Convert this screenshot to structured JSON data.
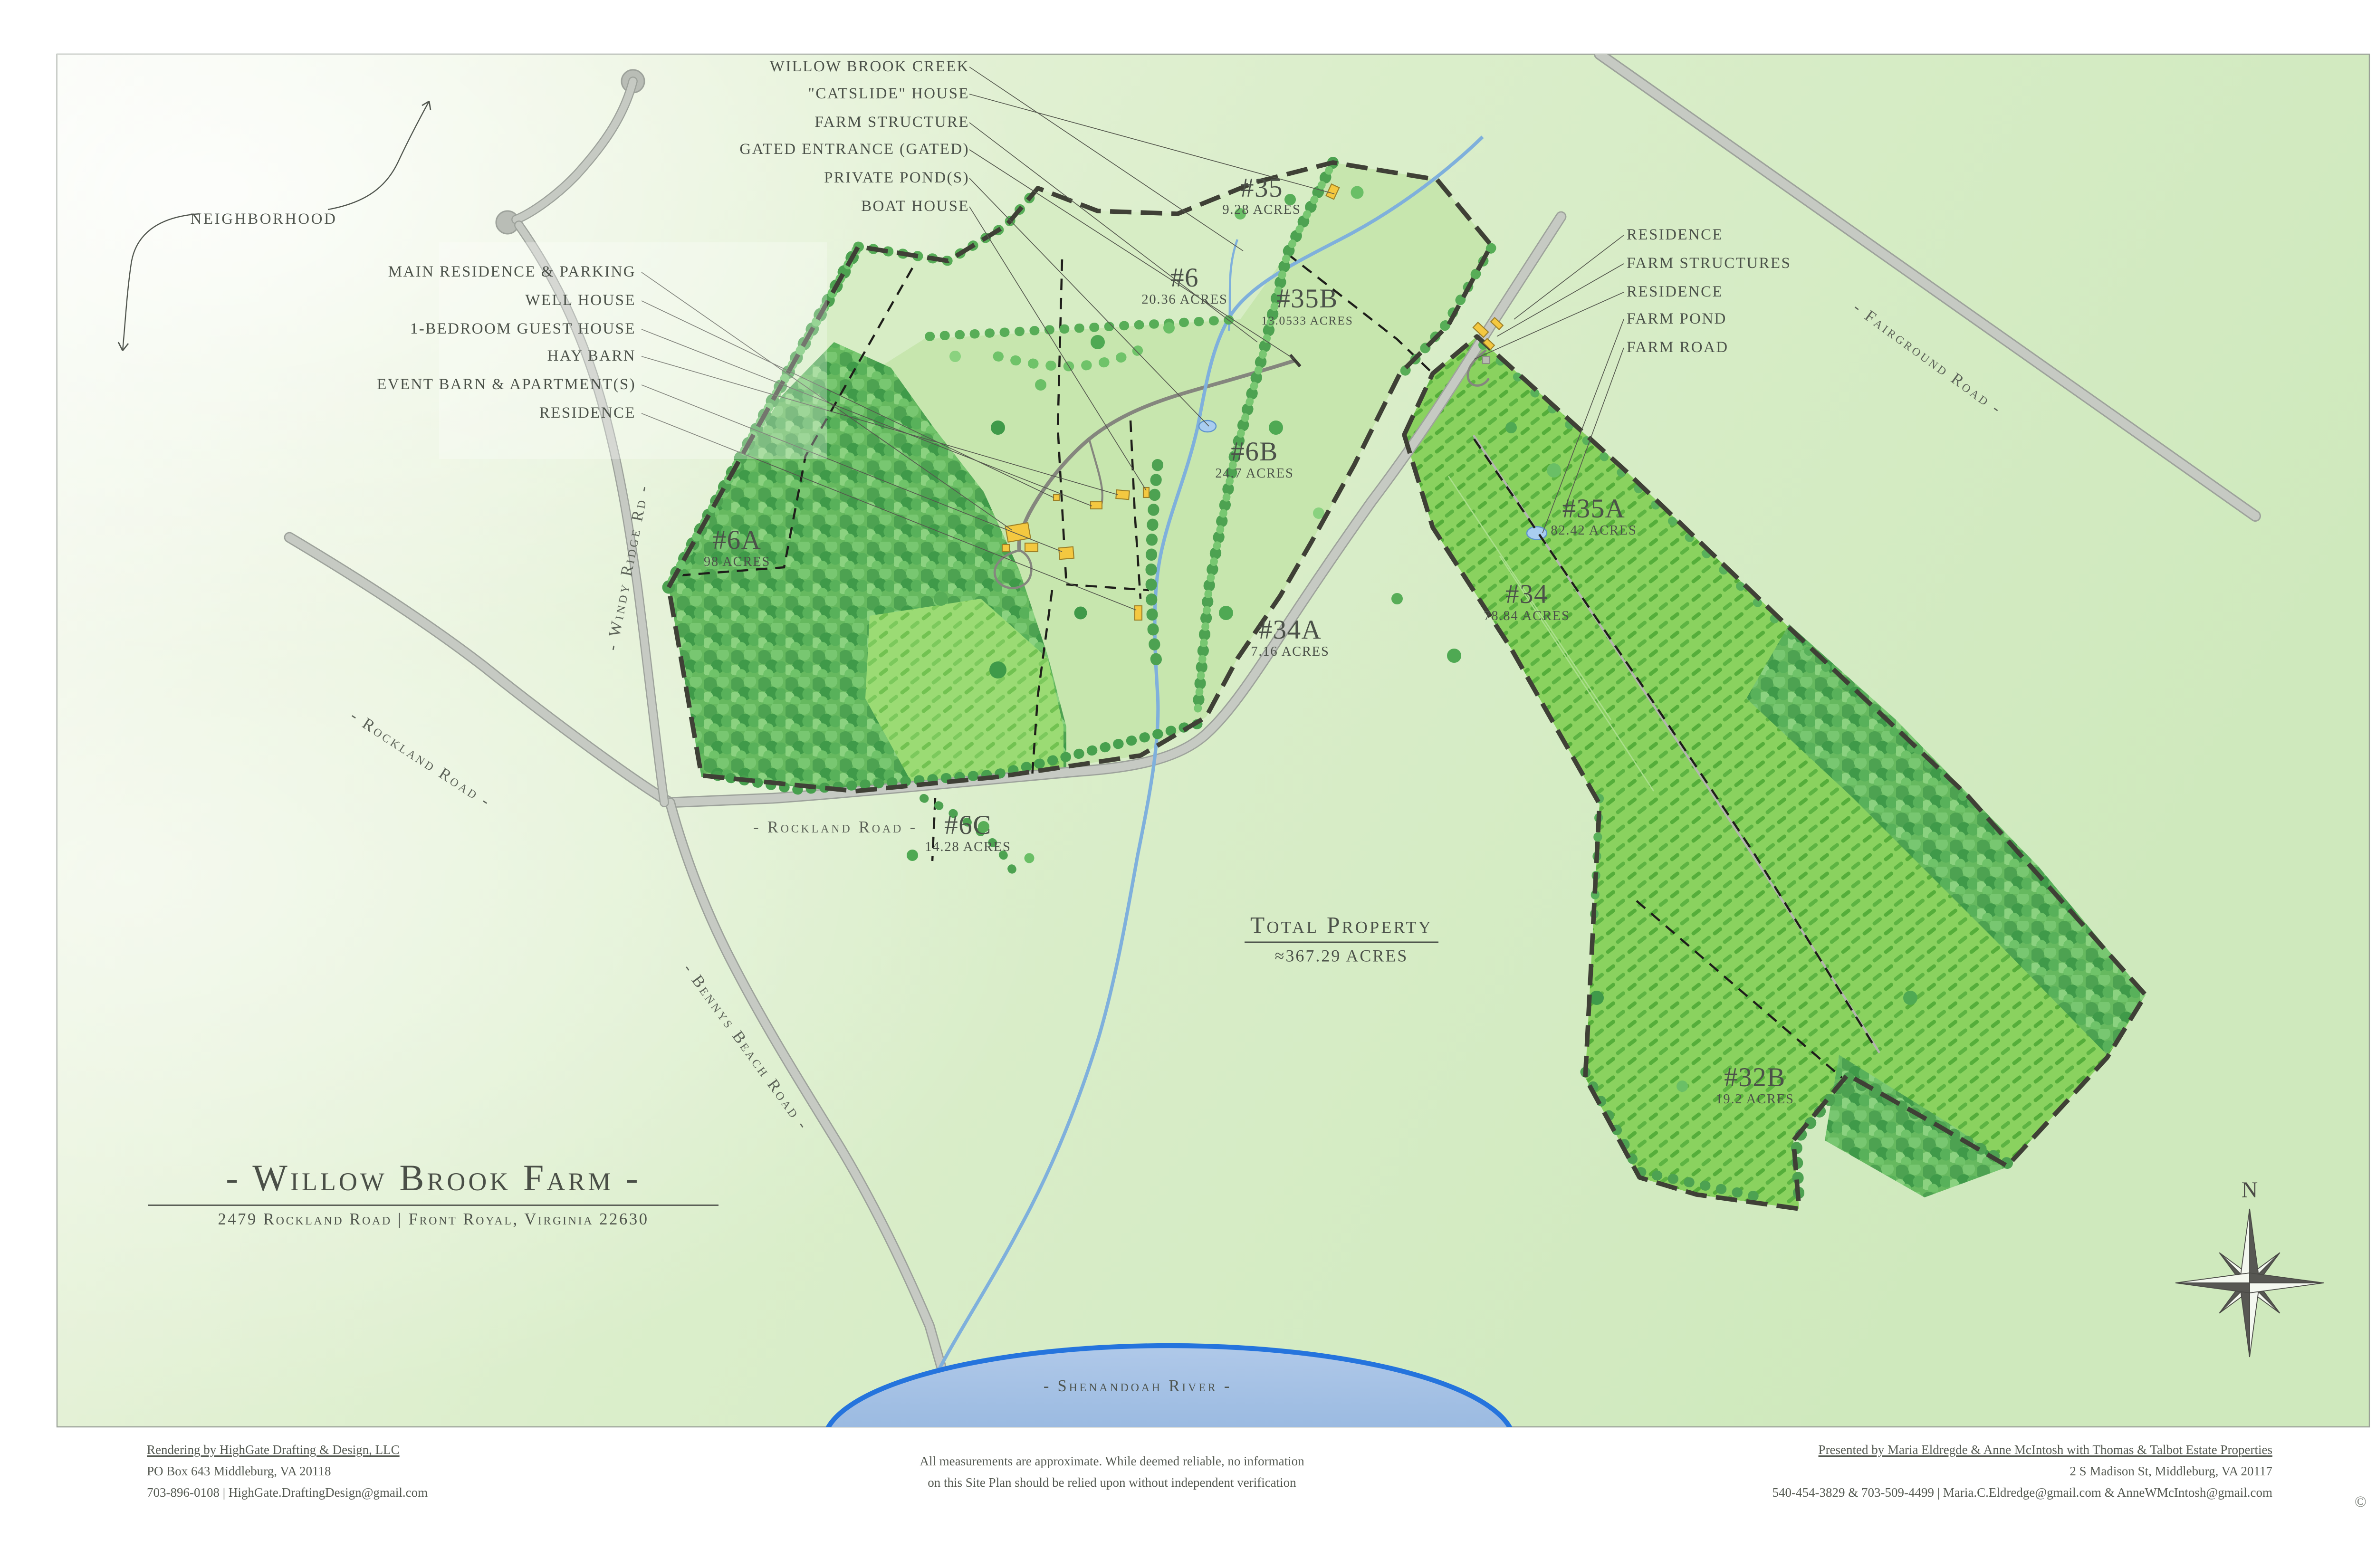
{
  "title_block": {
    "title": "- Willow Brook Farm -",
    "address": "2479 Rockland Road  |  Front Royal, Virginia 22630"
  },
  "map": {
    "total": {
      "label": "Total Property",
      "acres": "≈367.29 ACRES"
    },
    "parcels": [
      {
        "id": "#35",
        "acres": "9.28 ACRES"
      },
      {
        "id": "#6",
        "acres": "20.36 ACRES"
      },
      {
        "id": "#35B",
        "acres": "13.0533 ACRES"
      },
      {
        "id": "#6A",
        "acres": "98 ACRES"
      },
      {
        "id": "#6B",
        "acres": "24.7 ACRES"
      },
      {
        "id": "#35A",
        "acres": "82.42 ACRES"
      },
      {
        "id": "#34",
        "acres": "78.84 ACRES"
      },
      {
        "id": "#34A",
        "acres": "7.16 ACRES"
      },
      {
        "id": "#6C",
        "acres": "14.28 ACRES"
      },
      {
        "id": "#32B",
        "acres": "19.2 ACRES"
      }
    ],
    "callouts_top": [
      "WILLOW BROOK CREEK",
      "\"CATSLIDE\" HOUSE",
      "FARM STRUCTURE",
      "GATED ENTRANCE (GATED)",
      "PRIVATE POND(S)",
      "BOAT HOUSE"
    ],
    "callouts_left": [
      "MAIN RESIDENCE & PARKING",
      "WELL HOUSE",
      "1-BEDROOM GUEST HOUSE",
      "HAY BARN",
      "EVENT BARN & APARTMENT(S)",
      "RESIDENCE"
    ],
    "callouts_right": [
      "RESIDENCE",
      "FARM STRUCTURES",
      "RESIDENCE",
      "FARM POND",
      "FARM ROAD"
    ],
    "roads": {
      "neighborhood": "NEIGHBORHOOD",
      "windy_ridge": "- Windy Ridge Rd -",
      "rockland_west": "- Rockland Road -",
      "rockland_center": "- Rockland Road -",
      "bennys_beach": "- Bennys Beach Road -",
      "fairground": "- Fairground Road -"
    },
    "river": "- Shenandoah River -",
    "compass_north": "N"
  },
  "footer": {
    "left1": "Rendering by HighGate Drafting & Design, LLC",
    "left2": "PO Box 643 Middleburg, VA 20118",
    "left3": "703-896-0108  |  HighGate.DraftingDesign@gmail.com",
    "center1": "All measurements are approximate. While deemed reliable, no information",
    "center2": "on this Site Plan should be relied upon without independent verification",
    "right1": "Presented by Maria Eldregde & Anne McIntosh with Thomas & Talbot Estate Properties",
    "right2": "2 S Madison St, Middleburg, VA 20117",
    "right3": "540-454-3829 & 703-509-4499  |  Maria.C.Eldredge@gmail.com & AnneWMcIntosh@gmail.com",
    "copyright": "©"
  },
  "colors": {
    "map_background": "#d8ecc6",
    "open_parcel": "#d7edc5",
    "farm_parcel": "#c7e6ae",
    "crop_field": "#8ad25f",
    "forest_green": "#4da251",
    "road_gray": "#c6cac3",
    "creek_blue": "#7fb0dc",
    "river_stroke": "#2574dd",
    "boundary": "#3f4036",
    "building_yellow": "#f4c840",
    "label_text": "#4b5149"
  }
}
